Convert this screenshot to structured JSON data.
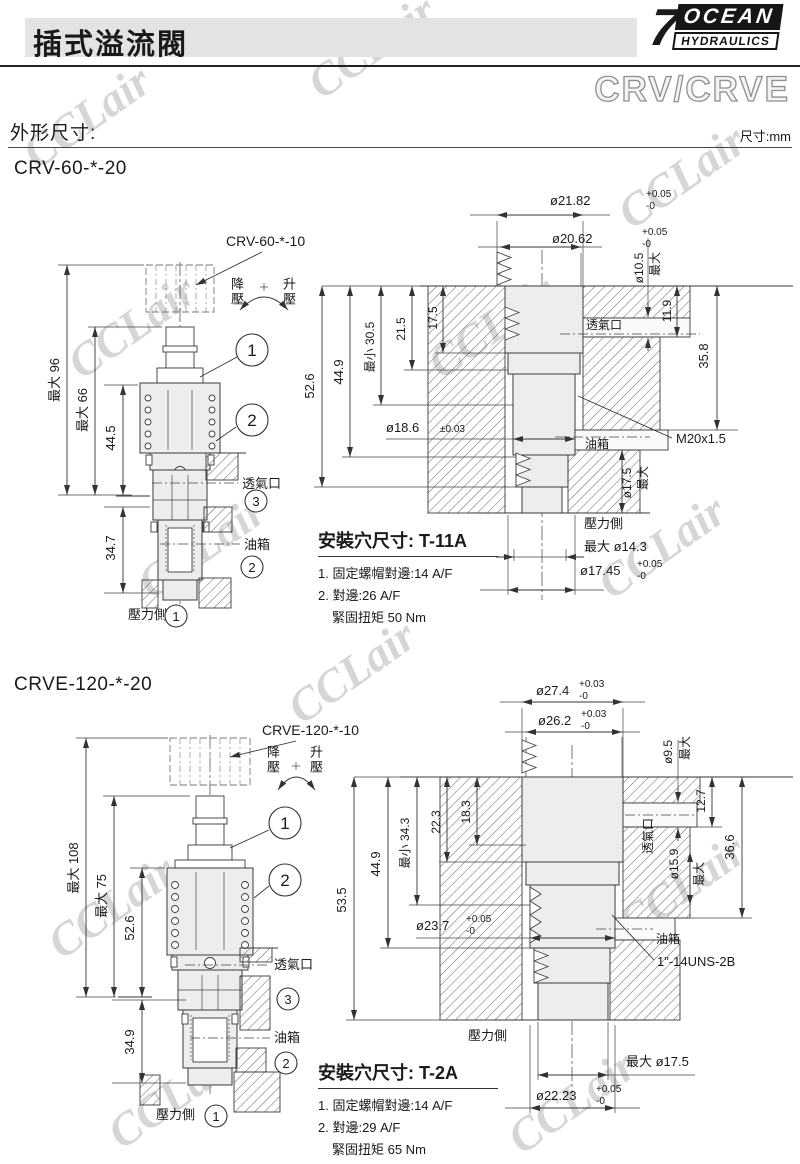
{
  "header": {
    "title": "插式溢流閥",
    "logo": {
      "seven": "7",
      "name": "OCEAN",
      "sub": "HYDRAULICS"
    },
    "series": "CRV/CRVE",
    "section": "外形尺寸:",
    "unit": "尺寸:mm"
  },
  "watermark": "CCLair",
  "crv": {
    "model": "CRV-60-*-20",
    "cartridge": "CRV-60-*-10",
    "dial": {
      "down": "降壓",
      "up": "升壓"
    },
    "callout1": "1",
    "callout2": "2",
    "callout3": "3",
    "outline": {
      "max_height": "最大 96",
      "max_body": "最大 66",
      "body_len": "44.5",
      "nose_len": "34.7",
      "vent": "透氣口",
      "tank": "油箱",
      "pressure": "壓力側"
    },
    "cavity": {
      "top_dia1": "ø21.82",
      "top_dia1_tp": "+0.05",
      "top_dia1_tm": "-0",
      "top_dia2": "ø20.62",
      "top_dia2_tp": "+0.05",
      "top_dia2_tm": "-0",
      "vent_dia": "ø10.5",
      "vent_dia_max": "最大",
      "vent_depth": "11.9",
      "tank_depth": "35.8",
      "step1": "17.5",
      "step2": "21.5",
      "step3": "最小 30.5",
      "step4": "44.9",
      "step5": "52.6",
      "bore_dia": "ø18.6",
      "bore_tol": "±0.03",
      "vent": "透氣口",
      "tank": "油箱",
      "thread": "M20x1.5",
      "spigot_dia": "ø17.5",
      "spigot_max": "最大",
      "pressure": "壓力側",
      "seat_dia": "最大 ø14.3",
      "exit_dia": "ø17.45",
      "exit_tp": "+0.05",
      "exit_tm": "-0"
    },
    "install": {
      "title": "安裝穴尺寸:",
      "code": "T-11A",
      "note1": "1. 固定螺帽對邊:14 A/F",
      "note2": "2. 對邊:26 A/F",
      "note3": "緊固扭矩 50 Nm"
    }
  },
  "crve": {
    "model": "CRVE-120-*-20",
    "cartridge": "CRVE-120-*-10",
    "dial": {
      "down": "降壓",
      "up": "升壓"
    },
    "callout1": "1",
    "callout2": "2",
    "callout3": "3",
    "outline": {
      "max_height": "最大 108",
      "max_body": "最大 75",
      "body_len": "52.6",
      "nose_len": "34.9",
      "vent": "透氣口",
      "tank": "油箱",
      "pressure": "壓力側"
    },
    "cavity": {
      "top_dia1": "ø27.4",
      "top_dia1_tp": "+0.03",
      "top_dia1_tm": "-0",
      "top_dia2": "ø26.2",
      "top_dia2_tp": "+0.03",
      "top_dia2_tm": "-0",
      "vent_dia": "ø9.5",
      "vent_dia_max": "最大",
      "vent_depth": "12.7",
      "tank_depth": "36.6",
      "step1": "18.3",
      "step2": "22.3",
      "step3": "最小 34.3",
      "step4": "44.9",
      "step5": "53.5",
      "bore_dia": "ø23.7",
      "bore_tp": "+0.05",
      "bore_tm": "-0",
      "port_dia": "ø15.9",
      "port_max": "最大",
      "vent": "透氣口",
      "tank": "油箱",
      "thread": "1\"-14UNS-2B",
      "pressure": "壓力側",
      "seat_dia": "最大 ø17.5",
      "exit_dia": "ø22.23",
      "exit_tp": "+0.05",
      "exit_tm": "-0"
    },
    "install": {
      "title": "安裝穴尺寸:",
      "code": "T-2A",
      "note1": "1. 固定螺帽對邊:14 A/F",
      "note2": "2. 對邊:29 A/F",
      "note3": "緊固扭矩 65 Nm"
    }
  }
}
